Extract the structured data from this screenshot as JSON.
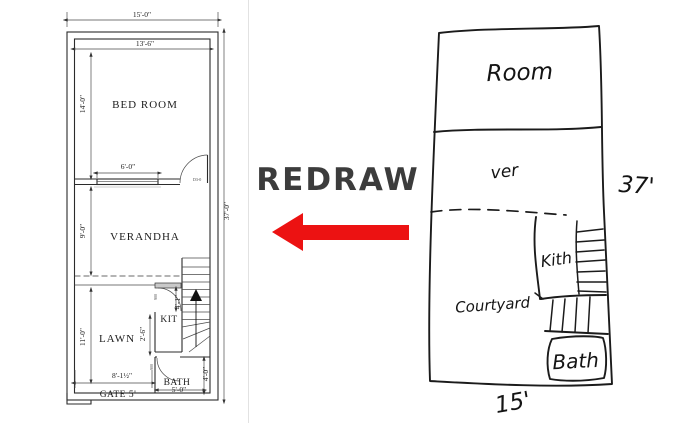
{
  "page": {
    "background": "#ffffff",
    "divider_color": "#e2e2e2"
  },
  "redraw": {
    "label": "REDRAW",
    "text_color": "#3c3c3c",
    "arrow_color": "#ec1212",
    "arrow_direction": "left"
  },
  "plan": {
    "rooms": {
      "bedroom": "BED ROOM",
      "verandah": "VERANDHA",
      "lawn": "LAWN",
      "kitchen": "KIT",
      "bath": "BATH"
    },
    "dims": {
      "width_overall": "15'-0\"",
      "width_inner": "13'-6\"",
      "bedroom_height": "14'-0\"",
      "window_width": "6'-0\"",
      "height_overall": "37'-0\"",
      "verandah_height": "9'-0\"",
      "lawn_height": "11'-0\"",
      "kitchen_height": "4'-1\"",
      "kitchen_width": "2'-6\"",
      "lawn_width": "8'-1½\"",
      "bath_width": "5'-0\"",
      "bath_height": "4'-0\"",
      "gate": "GATE 5'"
    },
    "door_tags": {
      "bedroom": "D3-0",
      "kitchen": "900",
      "bath": "900"
    }
  },
  "sketch": {
    "labels": {
      "room": "Room",
      "ver": "ver",
      "height": "37'",
      "kith": "Kith",
      "courtyard": "Courtyard",
      "bath": "Bath",
      "width": "15'"
    }
  }
}
